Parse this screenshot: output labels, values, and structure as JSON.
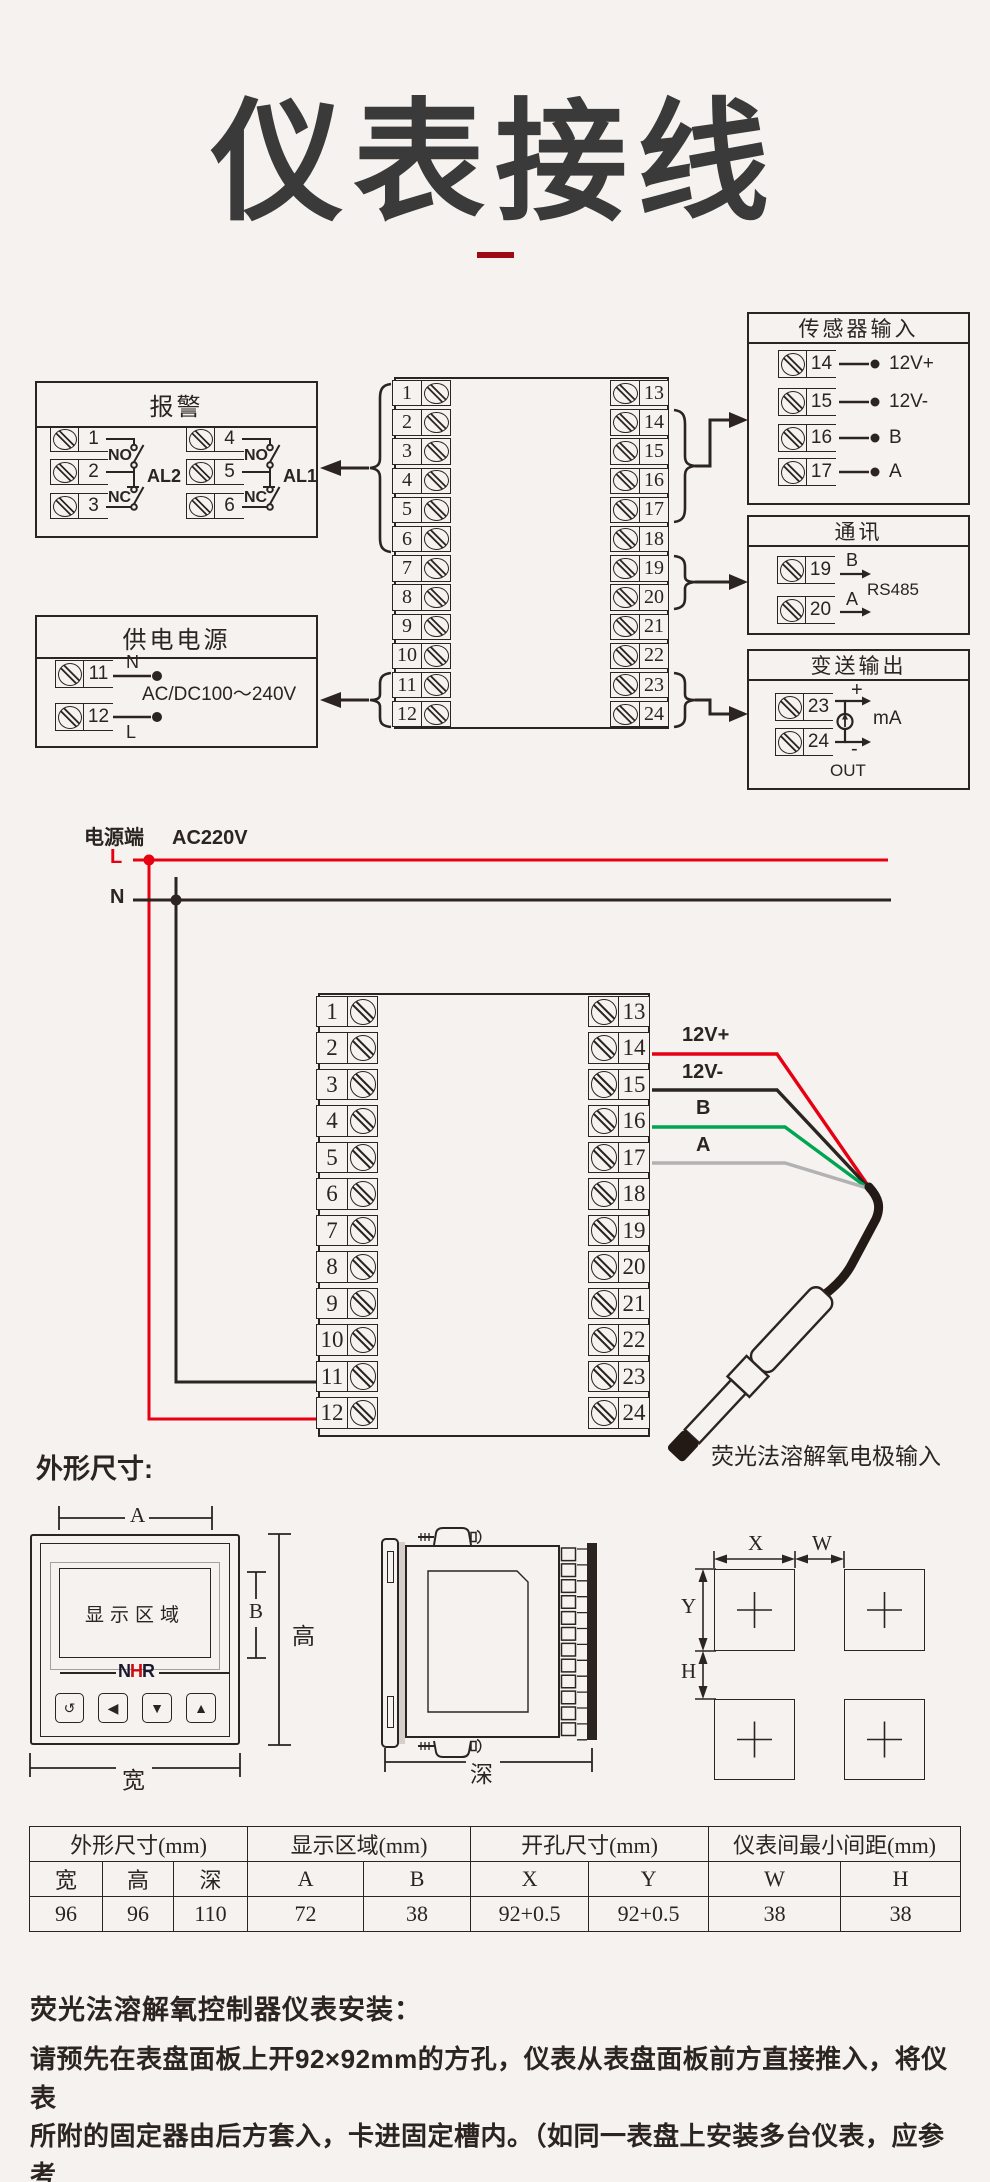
{
  "colors": {
    "ink": "#2b2420",
    "red": "#e60012",
    "green": "#00a551",
    "gray": "#b2b2b2",
    "dark_red": "#9d0a12",
    "brand_red": "#cd0a0f",
    "title_gray": "#3a3a3a"
  },
  "header": {
    "title": "仪表接线"
  },
  "d1": {
    "alarm": {
      "title": "报警",
      "t": [
        "1",
        "2",
        "3",
        "4",
        "5",
        "6"
      ],
      "no": "NO",
      "nc": "NC",
      "al2": "AL2",
      "al1": "AL1"
    },
    "power": {
      "title": "供电电源",
      "t11": "11",
      "t12": "12",
      "n": "N",
      "l": "L",
      "rating": "AC/DC100～240V"
    },
    "sensor": {
      "title": "传感器输入",
      "rows": [
        {
          "t": "14",
          "label": "12V+"
        },
        {
          "t": "15",
          "label": "12V-"
        },
        {
          "t": "16",
          "label": "B"
        },
        {
          "t": "17",
          "label": "A"
        }
      ]
    },
    "comm": {
      "title": "通讯",
      "rows": [
        {
          "t": "19",
          "label": "B"
        },
        {
          "t": "20",
          "label": "A"
        }
      ],
      "bus": "RS485"
    },
    "xmit": {
      "title": "变送输出",
      "t23": "23",
      "t24": "24",
      "plus": "+",
      "minus": "-",
      "unit": "mA",
      "out": "OUT"
    }
  },
  "block": {
    "left": [
      "1",
      "2",
      "3",
      "4",
      "5",
      "6",
      "7",
      "8",
      "9",
      "10",
      "11",
      "12"
    ],
    "right": [
      "13",
      "14",
      "15",
      "16",
      "17",
      "18",
      "19",
      "20",
      "21",
      "22",
      "23",
      "24"
    ]
  },
  "d2": {
    "terminal_label": "电源端",
    "voltage": "AC220V",
    "l": "L",
    "n": "N",
    "wire_labels": [
      "12V+",
      "12V-",
      "B",
      "A"
    ],
    "probe_label": "荧光法溶解氧电极输入"
  },
  "dims": {
    "heading": "外形尺寸:",
    "display_area": "显示区域",
    "brand": [
      "N",
      "H",
      "R"
    ],
    "buttons": [
      "↺",
      "◀",
      "▼",
      "▲"
    ],
    "a": "A",
    "b": "B",
    "height": "高",
    "width": "宽",
    "depth": "深",
    "x": "X",
    "w": "W",
    "y": "Y",
    "h": "H"
  },
  "table": {
    "g1": "外形尺寸(mm)",
    "g2": "显示区域(mm)",
    "g3": "开孔尺寸(mm)",
    "g4": "仪表间最小间距(mm)",
    "h": [
      "宽",
      "高",
      "深",
      "A",
      "B",
      "X",
      "Y",
      "W",
      "H"
    ],
    "v": [
      "96",
      "96",
      "110",
      "72",
      "38",
      "92+0.5",
      "92+0.5",
      "38",
      "38"
    ]
  },
  "install": {
    "heading": "荧光法溶解氧控制器仪表安装：",
    "lines": [
      "请预先在表盘面板上开92×92mm的方孔，仪表从表盘面板前方直接推入，将仪表",
      "所附的固定器由后方套入，卡进固定槽内。（如同一表盘上安装多台仪表，应参考",
      "下图中推荐的仪表间最小间距，以保证必要的散热及装卸空间）"
    ]
  }
}
